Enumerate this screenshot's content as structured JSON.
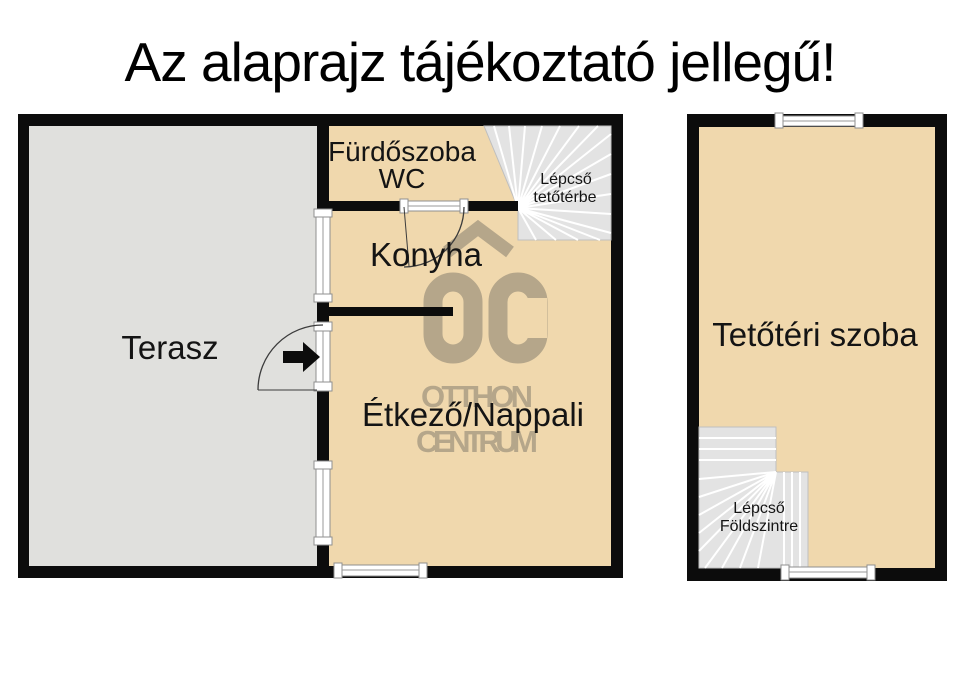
{
  "title": "Az alaprajz tájékoztató jellegű!",
  "floors": {
    "ground": {
      "rooms": {
        "terasz": "Terasz",
        "furdoszoba": "Fürdőszoba",
        "wc": "WC",
        "konyha": "Konyha",
        "etkezo_nappali": "Étkező/Nappali"
      },
      "stairs": {
        "line1": "Lépcső",
        "line2": "tetőtérbe"
      }
    },
    "attic": {
      "rooms": {
        "tetoteri_szoba": "Tetőtéri szoba"
      },
      "stairs": {
        "line1": "Lépcső",
        "line2": "Földszintre"
      }
    }
  },
  "watermark": {
    "line1": "OTTHON",
    "line2": "CENTRUM"
  },
  "colors": {
    "wall": "#0c0c0c",
    "room_fill": "#f0d8ad",
    "terrace_fill": "#e0e0dd",
    "stair_fill": "#e3e3e3",
    "watermark": "#b5a68a",
    "window_frame": "#8f8f8f",
    "title_text": "#000000"
  }
}
